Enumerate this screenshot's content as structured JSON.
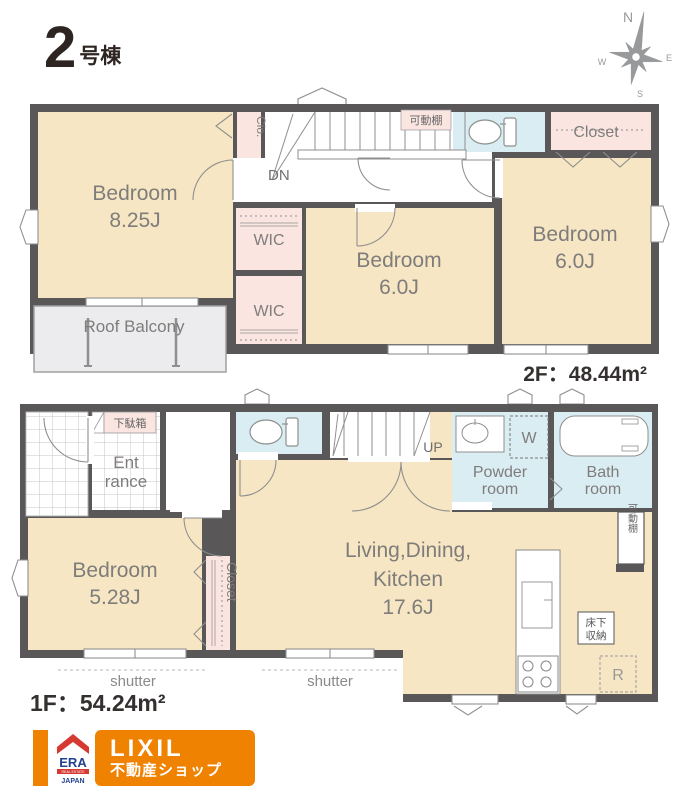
{
  "header": {
    "building_number": "2",
    "building_suffix": "号棟"
  },
  "compass": {
    "north": "N",
    "east": "E",
    "west": "W",
    "south": "S"
  },
  "floor2": {
    "area_label": {
      "floor": "2F",
      "separator": "：",
      "value": "48.44",
      "unit": "m²"
    },
    "bedroom_main": {
      "label": "Bedroom",
      "size": "8.25J"
    },
    "bedroom_center": {
      "label": "Bedroom",
      "size": "6.0J"
    },
    "bedroom_right": {
      "label": "Bedroom",
      "size": "6.0J"
    },
    "wic_upper": "WIC",
    "wic_lower": "WIC",
    "clo": "Clo.",
    "closet": "Closet",
    "movable_shelf": "可動棚",
    "stairs_down": "DN",
    "roof_balcony": "Roof Balcony"
  },
  "floor1": {
    "area_label": {
      "floor": "1F",
      "separator": "：",
      "value": "54.24",
      "unit": "m²"
    },
    "entrance_line1": "Ent",
    "entrance_line2": "rance",
    "shoe_box": "下駄箱",
    "stairs_up": "UP",
    "bedroom": {
      "label": "Bedroom",
      "size": "5.28J"
    },
    "ldk": {
      "line1": "Living,Dining,",
      "line2": "Kitchen",
      "size": "17.6J"
    },
    "powder_room": {
      "line1": "Powder",
      "line2": "room"
    },
    "bath_room": {
      "line1": "Bath",
      "line2": "room"
    },
    "washer": "W",
    "closet": "Closet",
    "movable_shelf": "可動棚",
    "underfloor_storage": {
      "line1": "床下",
      "line2": "収納"
    },
    "refrigerator": "R",
    "shutter_left": "shutter",
    "shutter_center": "shutter"
  },
  "footer": {
    "era": {
      "name": "ERA",
      "tagline": "REAL ESTATE",
      "country": "JAPAN"
    },
    "lixil": {
      "name": "LIXIL",
      "sub": "不動産ショップ"
    }
  },
  "colors": {
    "wall": "#595757",
    "room_cream": "#f6e6c3",
    "closet_pink": "#fbe5e1",
    "wet_blue": "#daedf2",
    "balcony_gray": "#ececee",
    "line_gray": "#8f8f8f",
    "label_gray": "#7f7d7b",
    "accent_orange": "#ef8200",
    "era_red": "#d63832",
    "era_navy": "#24418e"
  }
}
